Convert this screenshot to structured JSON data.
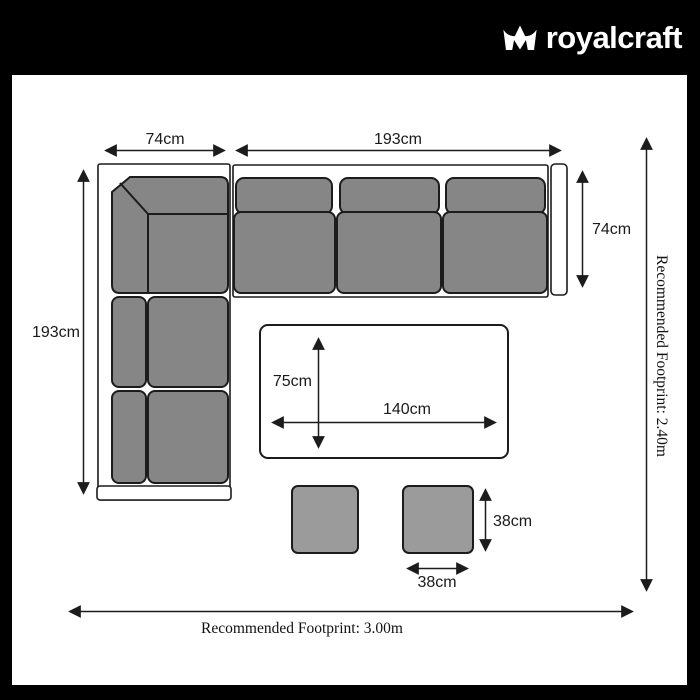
{
  "header": {
    "brand": "royalcraft",
    "logo_icon": "crown-icon"
  },
  "palette": {
    "header_bg": "#000000",
    "border": "#000000",
    "canvas": "#ffffff",
    "cushion_fill": "#868686",
    "stool_fill": "#9b9b9b",
    "outline": "#1c1c1c"
  },
  "dims": {
    "sofa_arm_width": "74cm",
    "sofa_top_length": "193cm",
    "sofa_left_length": "193cm",
    "sofa_depth": "74cm",
    "table_depth": "75cm",
    "table_length": "140cm",
    "stool_height": "38cm",
    "stool_width": "38cm"
  },
  "footprint": {
    "width_label": "Recommended Footprint: 3.00m",
    "height_label": "Recommended Footprint: 2.40m"
  }
}
